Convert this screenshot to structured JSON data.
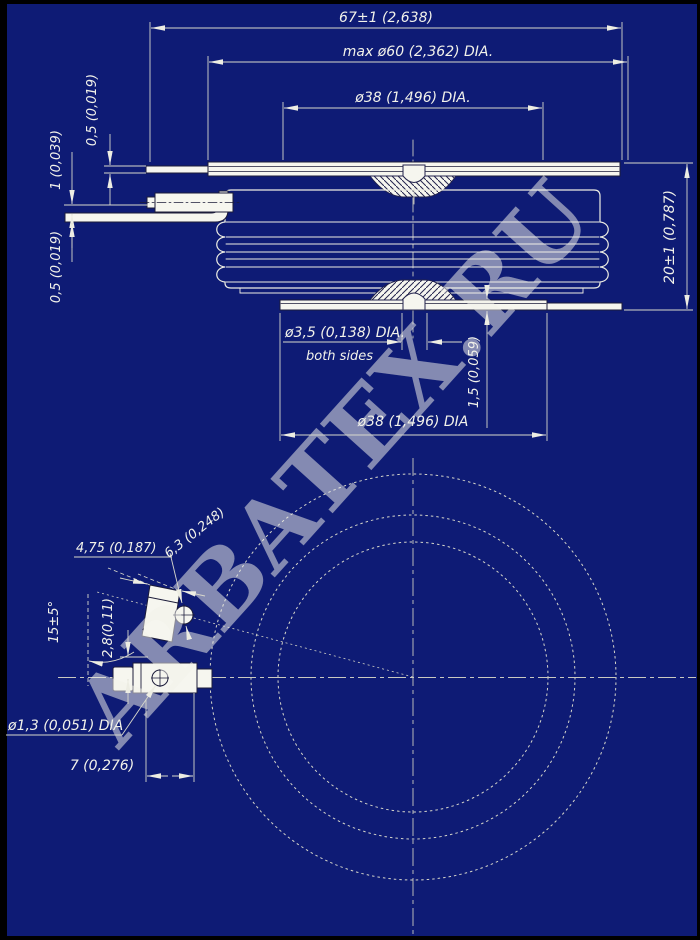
{
  "drawing": {
    "watermark": "ARBATEX.RU",
    "colors": {
      "background": "#0E1B75",
      "border": "#000000",
      "line": "#F0F0E6",
      "dim_line": "#D8D8CC",
      "shape_fill": "#F6F6EF",
      "shape_edge": "#1C1C3A",
      "watermark": "#C32462"
    },
    "side_view": {
      "dim_overall_width": "67±1 (2,638)",
      "dim_body_dia": "max ø60 (2,362) DIA.",
      "dim_pole_dia_top": "ø38 (1,496) DIA.",
      "dim_pole_dia_bottom": "ø38 (1,496) DIA",
      "dim_height": "20±1 (0,787)",
      "dim_flange_thickness": "0,5 (0,019)",
      "dim_lead_thickness": "1 (0,039)",
      "dim_lead_thickness_lower": "0,5 (0,019)",
      "dim_gate_hole": "ø3,5 (0,138) DIA.",
      "note_gate_hole": "both sides",
      "dim_recess_depth": "1,5 (0,059)"
    },
    "bottom_view": {
      "dim_terminal_width": "4,75 (0,187)",
      "dim_terminal_contact": "6,3 (0,248)",
      "dim_terminal_angle": "15±5°",
      "dim_terminal_offset": "2,8(0,11)",
      "dim_lead_hole": "ø1,3 (0,051) DIA",
      "dim_hole_position": "7 (0,276)"
    }
  }
}
